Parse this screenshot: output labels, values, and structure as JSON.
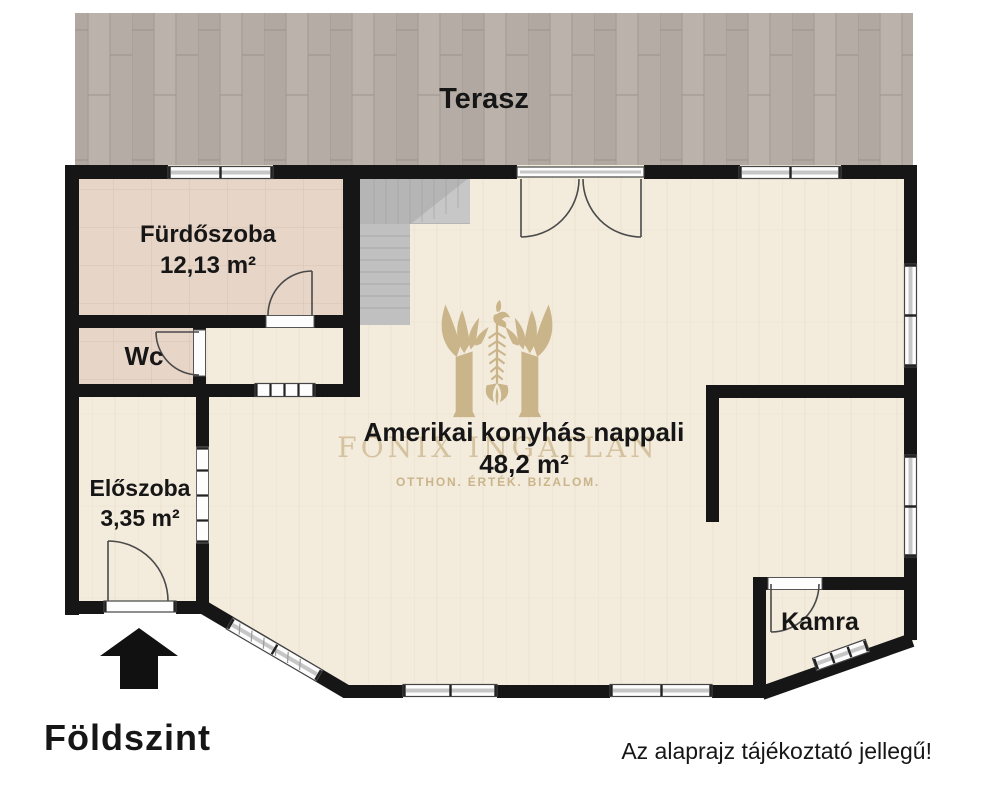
{
  "floorplan": {
    "title": "Földszint",
    "disclaimer": "Az alaprajz tájékoztató jellegű!",
    "rooms": [
      {
        "name": "Terasz",
        "area": ""
      },
      {
        "name": "Fürdőszoba",
        "area": "12,13 m²"
      },
      {
        "name": "Wc",
        "area": ""
      },
      {
        "name": "Előszoba",
        "area": "3,35 m²"
      },
      {
        "name": "Amerikai konyhás nappali",
        "area": "48,2 m²"
      },
      {
        "name": "Kamra",
        "area": ""
      }
    ],
    "watermark": {
      "logo": "phoenix-m-logo",
      "brand": "FŐNIX INGATLAN",
      "tagline": "OTTHON. ÉRTÉK. BIZALOM."
    },
    "colors": {
      "wall": "#161616",
      "gold": "#c3ab7c",
      "floor_main": "#f3ebdc",
      "floor_bath": "#e7d5c8",
      "terrace": "#b6aea6",
      "stairs": "#b9b9b9"
    }
  }
}
